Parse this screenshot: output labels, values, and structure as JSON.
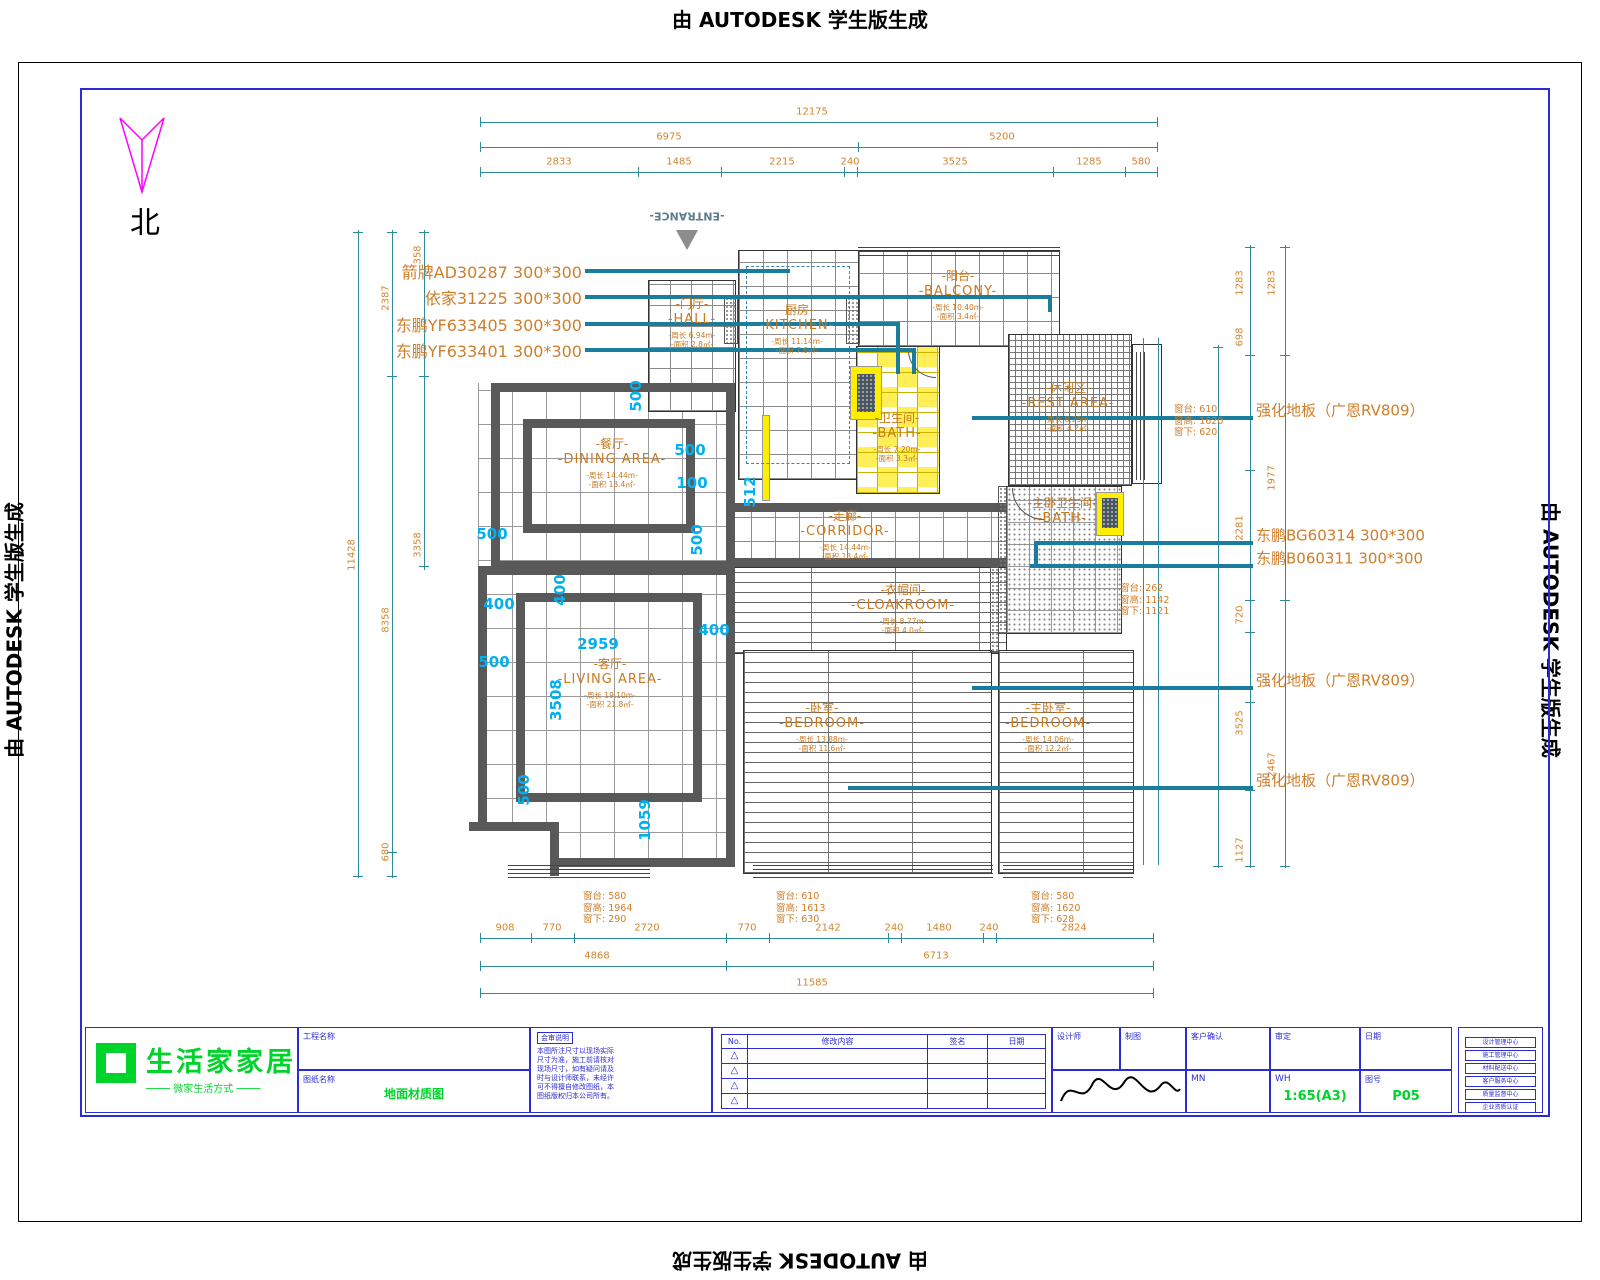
{
  "banner": "由 AUTODESK 学生版生成",
  "north_label": "北",
  "entrance_label": "-ENTRANCE-",
  "rooms": [
    {
      "cn": "-门厅-",
      "en": "-HALL-",
      "s1": "-周长 6.94m-",
      "s2": "-面积 2.8㎡-",
      "x": 692,
      "y": 322
    },
    {
      "cn": "-厨房-",
      "en": "-KITCHEN-",
      "s1": "-周长 11.14m-",
      "s2": "-面积 7.6㎡-",
      "x": 797,
      "y": 328
    },
    {
      "cn": "-阳台-",
      "en": "-BALCONY-",
      "s1": "-周长 10.40m-",
      "s2": "-面积 3.4㎡-",
      "x": 958,
      "y": 294
    },
    {
      "cn": "-卫生间-",
      "en": "-BATH-",
      "s1": "-周长 7.20m-",
      "s2": "-面积 3.3㎡-",
      "x": 897,
      "y": 436
    },
    {
      "cn": "-休闲区-",
      "en": "-REST AREA-",
      "s1": "-周长 8.25m-",
      "s2": "-面积 4.2㎡-",
      "x": 1068,
      "y": 406
    },
    {
      "cn": "-主卧卫生间-",
      "en": "-BATH-",
      "s1": "",
      "s2": "",
      "x": 1062,
      "y": 510
    },
    {
      "cn": "-餐厅-",
      "en": "-DINING AREA-",
      "s1": "-周长 14.44m-",
      "s2": "-面积 13.4㎡-",
      "x": 612,
      "y": 462
    },
    {
      "cn": "-走廊-",
      "en": "-CORRIDOR-",
      "s1": "-周长 14.44m-",
      "s2": "-面积 13.4㎡-",
      "x": 845,
      "y": 534
    },
    {
      "cn": "-衣帽间-",
      "en": "-CLOAKROOM-",
      "s1": "-周长 8.77m-",
      "s2": "-面积 4.0㎡-",
      "x": 903,
      "y": 608
    },
    {
      "cn": "-卧室-",
      "en": "-BEDROOM-",
      "s1": "-周长 13.88m-",
      "s2": "-面积 11.6㎡-",
      "x": 822,
      "y": 726
    },
    {
      "cn": "-主卧室-",
      "en": "-BEDROOM-",
      "s1": "-周长 14.06m-",
      "s2": "-面积 12.2㎡-",
      "x": 1048,
      "y": 726
    },
    {
      "cn": "-客厅-",
      "en": "-LIVING AREA-",
      "s1": "-周长 19.10m-",
      "s2": "-面积 21.8㎡-",
      "x": 610,
      "y": 682
    }
  ],
  "materials_left": [
    {
      "t": "箭牌AD30287  300*300",
      "x": 582,
      "y": 271
    },
    {
      "t": "依家31225  300*300",
      "x": 582,
      "y": 297
    },
    {
      "t": "东鹏YF633405  300*300",
      "x": 582,
      "y": 324
    },
    {
      "t": "东鹏YF633401  300*300",
      "x": 582,
      "y": 350
    }
  ],
  "materials_right": [
    {
      "t": "强化地板（广恩RV809）",
      "x": 1256,
      "y": 410
    },
    {
      "t": "东鹏BG60314  300*300",
      "x": 1256,
      "y": 535
    },
    {
      "t": "东鹏B060311  300*300",
      "x": 1256,
      "y": 558
    },
    {
      "t": "强化地板（广恩RV809）",
      "x": 1256,
      "y": 680
    },
    {
      "t": "强化地板（广恩RV809）",
      "x": 1256,
      "y": 780
    }
  ],
  "window_notes": [
    {
      "x": 1174,
      "y": 404,
      "l1": "窗台: 610",
      "l2": "窗高: 1620",
      "l3": "窗下: 620"
    },
    {
      "x": 1120,
      "y": 583,
      "l1": "窗台: 262",
      "l2": "窗高: 1142",
      "l3": "窗下: 1121"
    },
    {
      "x": 583,
      "y": 891,
      "l1": "窗台: 580",
      "l2": "窗高: 1964",
      "l3": "窗下: 290"
    },
    {
      "x": 776,
      "y": 891,
      "l1": "窗台: 610",
      "l2": "窗高: 1613",
      "l3": "窗下: 630"
    },
    {
      "x": 1031,
      "y": 891,
      "l1": "窗台: 580",
      "l2": "窗高: 1620",
      "l3": "窗下: 628"
    }
  ],
  "dims": {
    "h": [
      {
        "t": "12175",
        "x": 812,
        "y": 112
      },
      {
        "t": "6975",
        "x": 669,
        "y": 137
      },
      {
        "t": "5200",
        "x": 1002,
        "y": 137
      },
      {
        "t": "2833",
        "x": 559,
        "y": 162
      },
      {
        "t": "1485",
        "x": 679,
        "y": 162
      },
      {
        "t": "2215",
        "x": 782,
        "y": 162
      },
      {
        "t": "240",
        "x": 850,
        "y": 162
      },
      {
        "t": "3525",
        "x": 955,
        "y": 162
      },
      {
        "t": "1285",
        "x": 1089,
        "y": 162
      },
      {
        "t": "580",
        "x": 1141,
        "y": 162
      },
      {
        "t": "908",
        "x": 505,
        "y": 928
      },
      {
        "t": "770",
        "x": 552,
        "y": 928
      },
      {
        "t": "2720",
        "x": 647,
        "y": 928
      },
      {
        "t": "770",
        "x": 747,
        "y": 928
      },
      {
        "t": "2142",
        "x": 828,
        "y": 928
      },
      {
        "t": "240",
        "x": 894,
        "y": 928
      },
      {
        "t": "1480",
        "x": 939,
        "y": 928
      },
      {
        "t": "240",
        "x": 989,
        "y": 928
      },
      {
        "t": "2824",
        "x": 1074,
        "y": 928
      },
      {
        "t": "4868",
        "x": 597,
        "y": 956
      },
      {
        "t": "6713",
        "x": 936,
        "y": 956
      },
      {
        "t": "11585",
        "x": 812,
        "y": 983
      }
    ],
    "v": [
      {
        "t": "11428",
        "x": 352,
        "y": 555
      },
      {
        "t": "2387",
        "x": 386,
        "y": 298
      },
      {
        "t": "8358",
        "x": 386,
        "y": 620
      },
      {
        "t": "680",
        "x": 386,
        "y": 852
      },
      {
        "t": "358",
        "x": 418,
        "y": 255
      },
      {
        "t": "3358",
        "x": 418,
        "y": 545
      },
      {
        "t": "1283",
        "x": 1240,
        "y": 283
      },
      {
        "t": "1283",
        "x": 1272,
        "y": 283
      },
      {
        "t": "698",
        "x": 1240,
        "y": 337
      },
      {
        "t": "1977",
        "x": 1272,
        "y": 478
      },
      {
        "t": "2281",
        "x": 1240,
        "y": 528
      },
      {
        "t": "720",
        "x": 1240,
        "y": 615
      },
      {
        "t": "3525",
        "x": 1240,
        "y": 723
      },
      {
        "t": "2467",
        "x": 1272,
        "y": 765
      },
      {
        "t": "1127",
        "x": 1240,
        "y": 850
      }
    ]
  },
  "cyan": [
    {
      "t": "500",
      "x": 636,
      "y": 396,
      "v": 1
    },
    {
      "t": "500",
      "x": 690,
      "y": 450
    },
    {
      "t": "100",
      "x": 692,
      "y": 483
    },
    {
      "t": "500",
      "x": 492,
      "y": 534
    },
    {
      "t": "512",
      "x": 750,
      "y": 492,
      "v": 1
    },
    {
      "t": "500",
      "x": 697,
      "y": 540,
      "v": 1
    },
    {
      "t": "400",
      "x": 499,
      "y": 604
    },
    {
      "t": "400",
      "x": 560,
      "y": 590,
      "v": 1
    },
    {
      "t": "400",
      "x": 714,
      "y": 630
    },
    {
      "t": "500",
      "x": 494,
      "y": 662
    },
    {
      "t": "2959",
      "x": 598,
      "y": 644
    },
    {
      "t": "3508",
      "x": 556,
      "y": 700,
      "v": 1
    },
    {
      "t": "500",
      "x": 524,
      "y": 790,
      "v": 1
    },
    {
      "t": "1059",
      "x": 645,
      "y": 820,
      "v": 1
    }
  ],
  "titleblock": {
    "logo_text": "生活家家居",
    "logo_tagline": "──── 微家生活方式 ────",
    "project_label": "工程名称",
    "drawing_label": "图纸名称",
    "drawing_value": "地面材质图",
    "note_title": "会审说明",
    "note_lines": [
      "本图所注尺寸以现场实际",
      "尺寸为准，施工前请核对",
      "现场尺寸，如有疑问请及",
      "时与设计师联系，未经许",
      "可不得擅自修改图纸，本",
      "图纸版权归本公司所有。"
    ],
    "rev_headers": [
      "No.",
      "修改内容",
      "签名",
      "日期"
    ],
    "warn_symbol": "△",
    "fields": {
      "designer": "设计师",
      "draft": "制图",
      "client": "客户确认",
      "approve": "审定",
      "date": "日期",
      "mn": "MN",
      "wh": "WH",
      "scale_label": "比例",
      "scale": "1:65(A3)",
      "sheet_label": "图号",
      "sheet": "P05"
    },
    "info_boxes": [
      "设计管理中心",
      "施工管理中心",
      "材料配送中心",
      "客户服务中心",
      "质量监督中心",
      "企业资质认证"
    ]
  }
}
